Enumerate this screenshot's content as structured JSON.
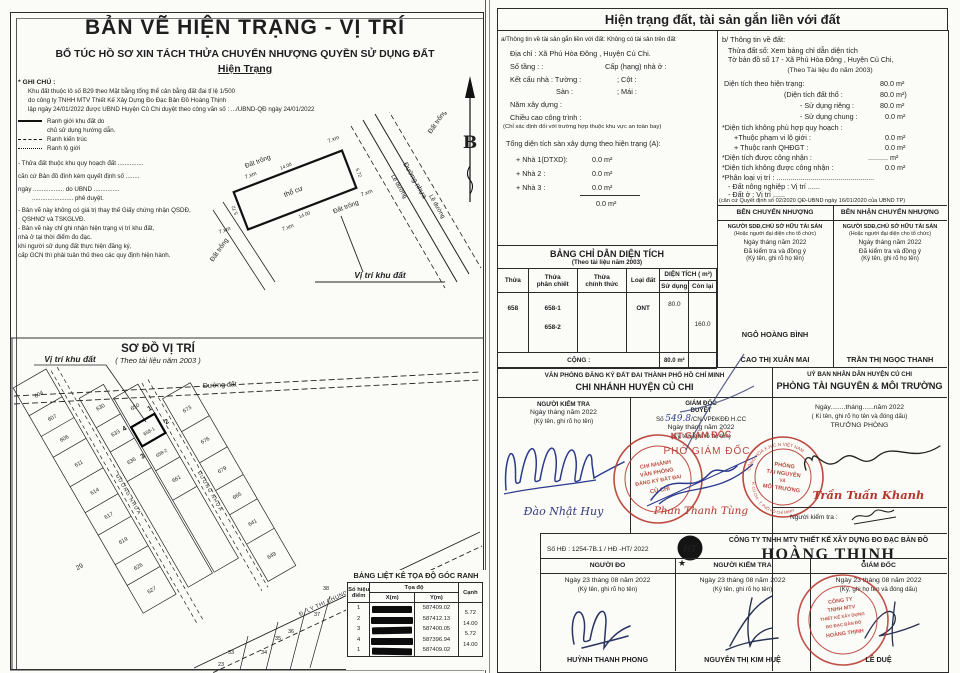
{
  "left": {
    "title": "BẢN VẼ HIỆN TRẠNG - VỊ TRÍ",
    "subtitle": "BỔ TÚC HỒ SƠ XIN TÁCH THỬA CHUYỂN NHƯỢNG QUYỀN SỬ DỤNG ĐẤT",
    "subtitle2": "Hiện Trạng",
    "notes_title": "* GHI CHÚ :",
    "notes": [
      "Khu đất thuộc lô số B29 theo Mặt bằng tổng thể cân bằng đất đai tỉ lệ 1/500",
      "do công ty TNHH MTV Thiết Kế Xây Dựng Đo Đạc Bản Đồ Hoàng Thịnh",
      "lập ngày 24/01/2022 được UBND Huyện Củ Chi duyệt theo công văn số : .../UBND-QĐ ngày 24/01/2022",
      "- Thửa đất thuộc khu quy hoạch đất ...............",
      "căn cứ Bản đồ đính kèm quyết định số ........",
      "ngày .................. do UBND ...............",
      "........................ phê duyệt.",
      "- Bản vẽ này không có giá trị thay thế Giấy chứng nhận QSDĐ,",
      "QSHNƠ và TSKGLVĐ.",
      "- Bản vẽ này chỉ ghi nhận hiện trạng vị trí khu đất,",
      "nhà ở tại thời điểm đo đạc.",
      "khi người sử dụng đất thực hiện đăng ký,",
      "cấp GCN thì phải tuân thủ theo các quy định hiện hành."
    ],
    "legend": {
      "l1a": "Ranh giới khu đất do",
      "l1b": "chủ sử dụng hướng dẫn.",
      "l2": "Ranh kiến trúc",
      "l3": "Ranh lộ giới"
    },
    "north": "B",
    "plot": {
      "caption": "Vị trí khu đất",
      "land": "thổ cư",
      "e1": "Đất trống",
      "e2": "Đất trống",
      "e3": "Đất trống",
      "e4": "Đất trống",
      "road": "Đường nhựa",
      "edge1": "Lề đường",
      "edge2": "Lề đường",
      "d_top": "14.00",
      "d_right": "5.72",
      "d_bottom": "14.00",
      "d_left": "5.72",
      "t1": "7.xm",
      "t2": "7.xm",
      "t3": "7.xm",
      "t4": "7.xm",
      "t5": "7.xm"
    },
    "plan": {
      "title": "SƠ ĐỒ VỊ TRÍ",
      "subtitle": "( Theo tài liệu năm 2003 )",
      "pointer": "Vị trí khu đất",
      "road_top": "Đường đất",
      "road_a": "ĐƯỜNG NHỰA",
      "road_b": "ĐƯỜNG NHỰA",
      "road_c": "Đ. LÝ THỊ CHUNG",
      "c1": "1",
      "c2": "2",
      "c3": "3",
      "c4": "4",
      "parcels": [
        "604",
        "607",
        "606",
        "611",
        "614",
        "617",
        "619",
        "626",
        "627",
        "29",
        "630",
        "633",
        "636",
        "650",
        "658-1",
        "658-2",
        "661",
        "673",
        "676",
        "679",
        "665",
        "641",
        "649",
        "38",
        "37",
        "36",
        "35",
        "34",
        "33",
        "23"
      ]
    },
    "coords": {
      "title": "BẢNG LIỆT KÊ TỌA ĐỘ GÓC RANH",
      "h_point1": "Số hiệu",
      "h_point2": "điểm",
      "h_coord": "Tọa độ",
      "h_x": "X(m)",
      "h_y": "Y(m)",
      "h_side": "Cạnh",
      "p": [
        "1",
        "2",
        "3",
        "4",
        "1"
      ],
      "y": [
        "587409.02",
        "587412.13",
        "587400.05",
        "587396.94",
        "587409.02"
      ],
      "s": [
        "5.72",
        "14.00",
        "5.72",
        "14.00"
      ]
    }
  },
  "right": {
    "header": "Hiện trạng đất, tài sản gắn liền với đất",
    "a": {
      "l0": "a/Thông tin về tài sản gắn liền với đất: Không có tài sản trên đất",
      "l1": "Địa chỉ : Xã Phú Hòa Đông , Huyện Củ Chi.",
      "l2": "Số tầng :       :",
      "l2b": "Cấp (hạng) nhà ở :",
      "l3": "Kết cấu nhà : Tường :",
      "l3b": "; Cột :",
      "l4": "Sàn :",
      "l4b": "; Mái :",
      "l5": "Năm xây dựng :",
      "l6": "Chiều cao công trình :",
      "l7": "(Chỉ xác định đối với trường hợp thuộc khu vực an toàn bay)",
      "l8": "Tổng diện tích sàn xây dựng theo hiện trạng (A):",
      "h1": "+ Nhà 1(DTXD):",
      "v1": "0.0 m²",
      "h2": "+ Nhà 2 :",
      "v2": "0.0 m²",
      "h3": "+ Nhà 3 :",
      "v3": "0.0 m²",
      "total": "0.0 m²"
    },
    "b": {
      "l0": "b/ Thông tin về đất:",
      "l1": "Thửa đất số:   Xem bảng chỉ dẫn diện tích",
      "l2": "Tờ bản đồ số 17 -  Xã Phú Hòa Đông , Huyện Củ Chi,",
      "l3": "(Theo Tài liệu đo năm 2003)",
      "r1l": "Diện tích theo hiện trạng:",
      "r1v": "80.0   m²",
      "r2l": "(Diện tích đất thổ :",
      "r2v": "80.0   m²)",
      "r3l": "- Sử dụng riêng :",
      "r3v": "80.0   m²",
      "r4l": "- Sử dụng chung :",
      "r4v": "0.0  m²",
      "l5": "*Diện tích không phù hợp quy hoạch :",
      "r6l": "+Thuộc phạm vi lộ giới :",
      "r6v": "0.0  m²",
      "r7l": "+ Thuộc ranh QHĐGT :",
      "r7v": "0.0  m²",
      "r8l": "*Diện tích được công nhận :",
      "r8v": "..........  m²",
      "r9l": "*Diện tích không được công nhận :",
      "r9v": "0.0  m²",
      "l10": "*Phân loại vị trí : .................................................",
      "l11": "- Đất nông nghiệp : Vị trí ......",
      "l12": "- Đất ở               : Vị trí ......",
      "l13": "(căn cứ Quyết định số 02/2020 QĐ-UBND ngày 16/01/2020 của UBND TP)"
    },
    "parties": {
      "h_left": "BÊN CHUYỂN NHƯỢNG",
      "h_right": "BÊN NHẬN CHUYỂN NHƯỢNG",
      "sub1": "NGƯỜI SDĐ,CHỦ SỞ HỮU TÀI SẢN",
      "sub2": "(Hoặc người đại diện cho tổ chức)",
      "sub3": "Ngày    tháng    năm 2022",
      "sub4": "Đã kiểm tra và đồng ý",
      "sub5": "(Ký tên, ghi rõ họ tên)",
      "name_l1": "NGÔ HOÀNG BÌNH",
      "name_l2": "CAO THỊ XUÂN MAI",
      "name_r1": "TRẦN THỊ NGỌC THANH"
    },
    "area_table": {
      "title": "BẢNG CHỈ DẪN DIỆN TÍCH",
      "subtitle": "(Theo tài liệu năm 2003)",
      "h_thua": "Thửa",
      "h_pc1": "Thửa",
      "h_pc2": "phân chiết",
      "h_ct1": "Thửa",
      "h_ct2": "chính thức",
      "h_loai": "Loại đất",
      "h_dt": "DIỆN TÍCH ( m²)",
      "h_sd": "Sử dụng",
      "h_cl": "Còn lại",
      "thua": "658",
      "pc1": "658-1",
      "pc2": "658-2",
      "loai": "ONT",
      "sd": "80.0",
      "cl": "160.0",
      "footer": "CỘNG   :",
      "footer_v": "80.0 m²"
    },
    "offices": {
      "lh1": "VĂN PHÒNG ĐĂNG KÝ ĐẤT ĐAI THÀNH PHỐ HỒ CHÍ MINH",
      "lh2": "CHI NHÁNH HUYỆN CỦ CHI",
      "rh1": "UỶ BAN NHÂN DÂN HUYỆN CỦ CHI",
      "rh2": "PHÒNG TÀI NGUYÊN & MÔI TRƯỜNG",
      "c1h": "NGƯỜI KIỂM TRA",
      "c1d": "Ngày    tháng    năm 2022",
      "c1s": "(Ký tên, ghi rõ họ tên)",
      "c1name": "Đào Nhật Huy",
      "c2h": "GIÁM ĐỐC",
      "c2h2": "DUYỆT",
      "c2no_pre": "Số",
      "c2no_hand": "549.8",
      "c2no_post": "/CN.VPĐKĐĐ H.CC",
      "c2d": "Ngày     tháng     năm 2022",
      "c2s": "(Ký tên, ghi rõ họ tên)",
      "c2kt": "KT GIÁM ĐỐC",
      "c2pgd": "PHÓ GIÁM ĐỐC",
      "c2name": "Phan Thanh Tùng",
      "c3d": "Ngày........tháng......năm 2022",
      "c3s": "( Kí tên, ghi rõ họ tên và đóng dấu)",
      "c3t": "TRƯỞNG PHÒNG",
      "c3name": "Trần Tuấn Khanh",
      "c3check": "Người kiểm tra :",
      "stamp1": [
        "CHI NHÁNH",
        "VĂN PHÒNG",
        "ĐĂNG KÝ ĐẤT ĐAI",
        "CỦ CHI"
      ],
      "stamp2_center": [
        "PHÒNG",
        "TÀI NGUYÊN",
        "VÀ",
        "MÔI TRƯỜNG"
      ],
      "stamp2_arc_top": "CỘNG HÒA X.H.C.N VIỆT NAM",
      "stamp2_arc_bottom": "H. CỦ CHI - T. PHỐ HỒ CHÍ MINH"
    },
    "company": {
      "contract": "Số HĐ : 1254-7B.1 / HĐ -HT/  2022",
      "logo": "HT",
      "star": "★",
      "name1": "CÔNG TY TNHH MTV THIẾT KẾ XÂY DỰNG ĐO ĐẠC BẢN ĐỒ",
      "name2": "HOÀNG THỊNH",
      "c1h": "NGƯỜI ĐO",
      "c2h": "NGƯỜI KIỂM TRA",
      "c3h": "GIÁM ĐỐC",
      "date": "Ngày 23 tháng 08 năm 2022",
      "sign": "(Ký tên, ghi rõ họ tên)",
      "sign3": "(Ký, ghi họ tên và đóng dấu)",
      "n1": "HUỲNH THANH PHONG",
      "n2": "NGUYỄN THỊ KIM HUỆ",
      "n3": "LÊ DUỆ",
      "stamp": [
        "CÔNG TY",
        "TNHH MTV",
        "THIẾT KẾ XÂY DỰNG",
        "ĐO ĐẠC BẢN ĐỒ",
        "HOÀNG THỊNH"
      ]
    }
  }
}
